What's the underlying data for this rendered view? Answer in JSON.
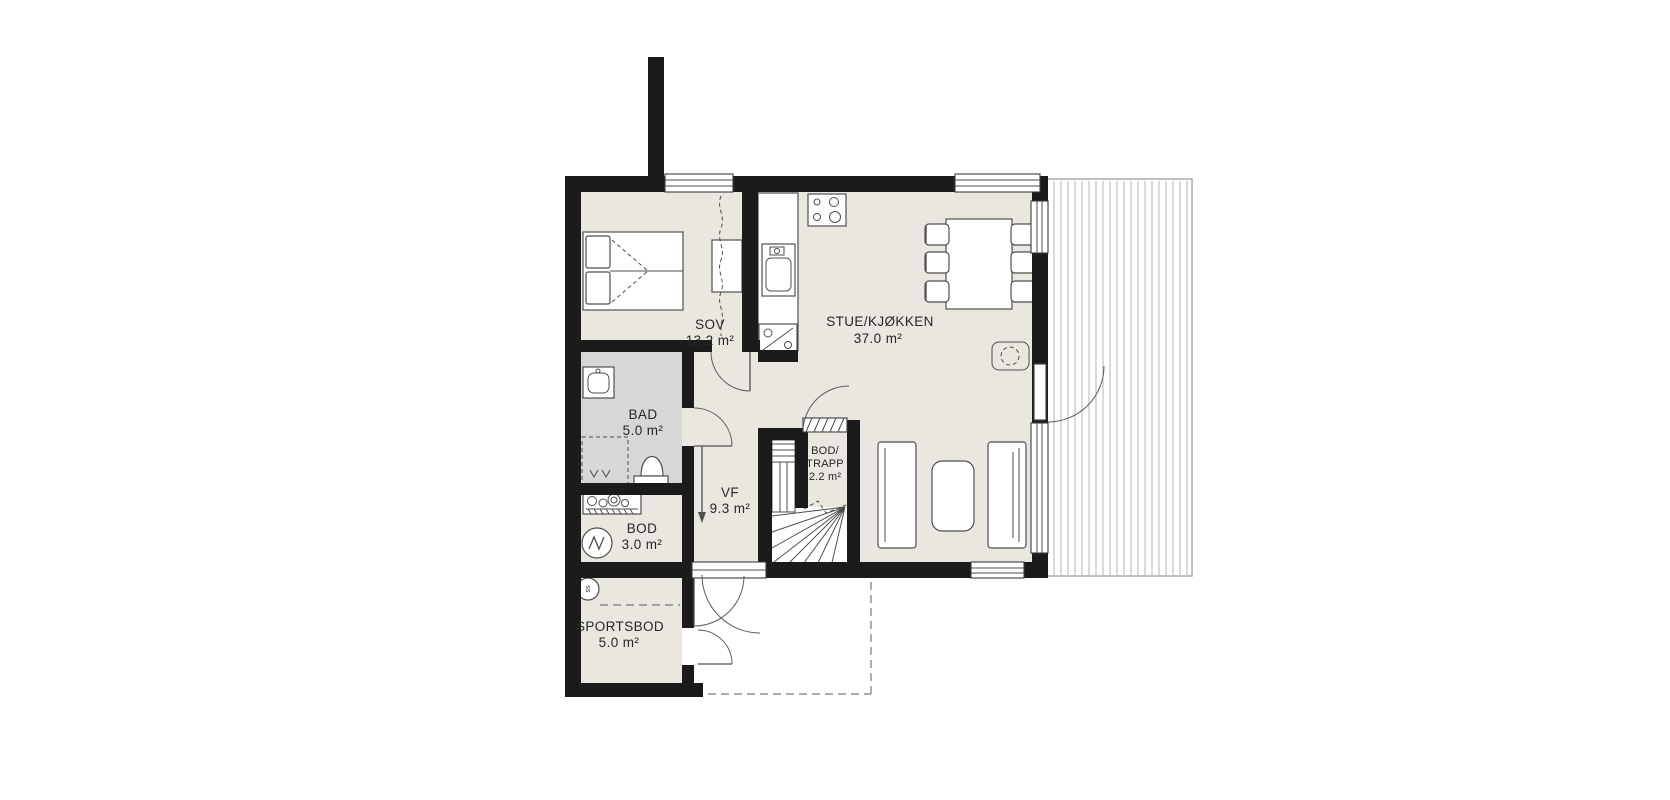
{
  "plan": {
    "title": "floor-plan",
    "rooms": [
      {
        "id": "sov",
        "name": "SOV",
        "area": "13.2 m²"
      },
      {
        "id": "stue",
        "name": "STUE/KJØKKEN",
        "area": "37.0 m²"
      },
      {
        "id": "bad",
        "name": "BAD",
        "area": "5.0 m²"
      },
      {
        "id": "vf",
        "name": "VF",
        "area": "9.3 m²"
      },
      {
        "id": "bod_trapp",
        "name": "BOD/",
        "name2": "TRAPP",
        "area": "2.2 m²"
      },
      {
        "id": "bod",
        "name": "BOD",
        "area": "3.0 m²"
      },
      {
        "id": "sportsbod",
        "name": "SPORTSBOD",
        "area": "5.0 m²"
      }
    ],
    "symbols": {
      "sportsbod_circle": "ss"
    },
    "colors": {
      "wall": "#1b1b1b",
      "floor": "#e9e7e0",
      "bath": "#d7d7d7",
      "line": "#4f4f4f",
      "dash": "#7a7a7a",
      "deck": "#b5b5b5"
    }
  }
}
